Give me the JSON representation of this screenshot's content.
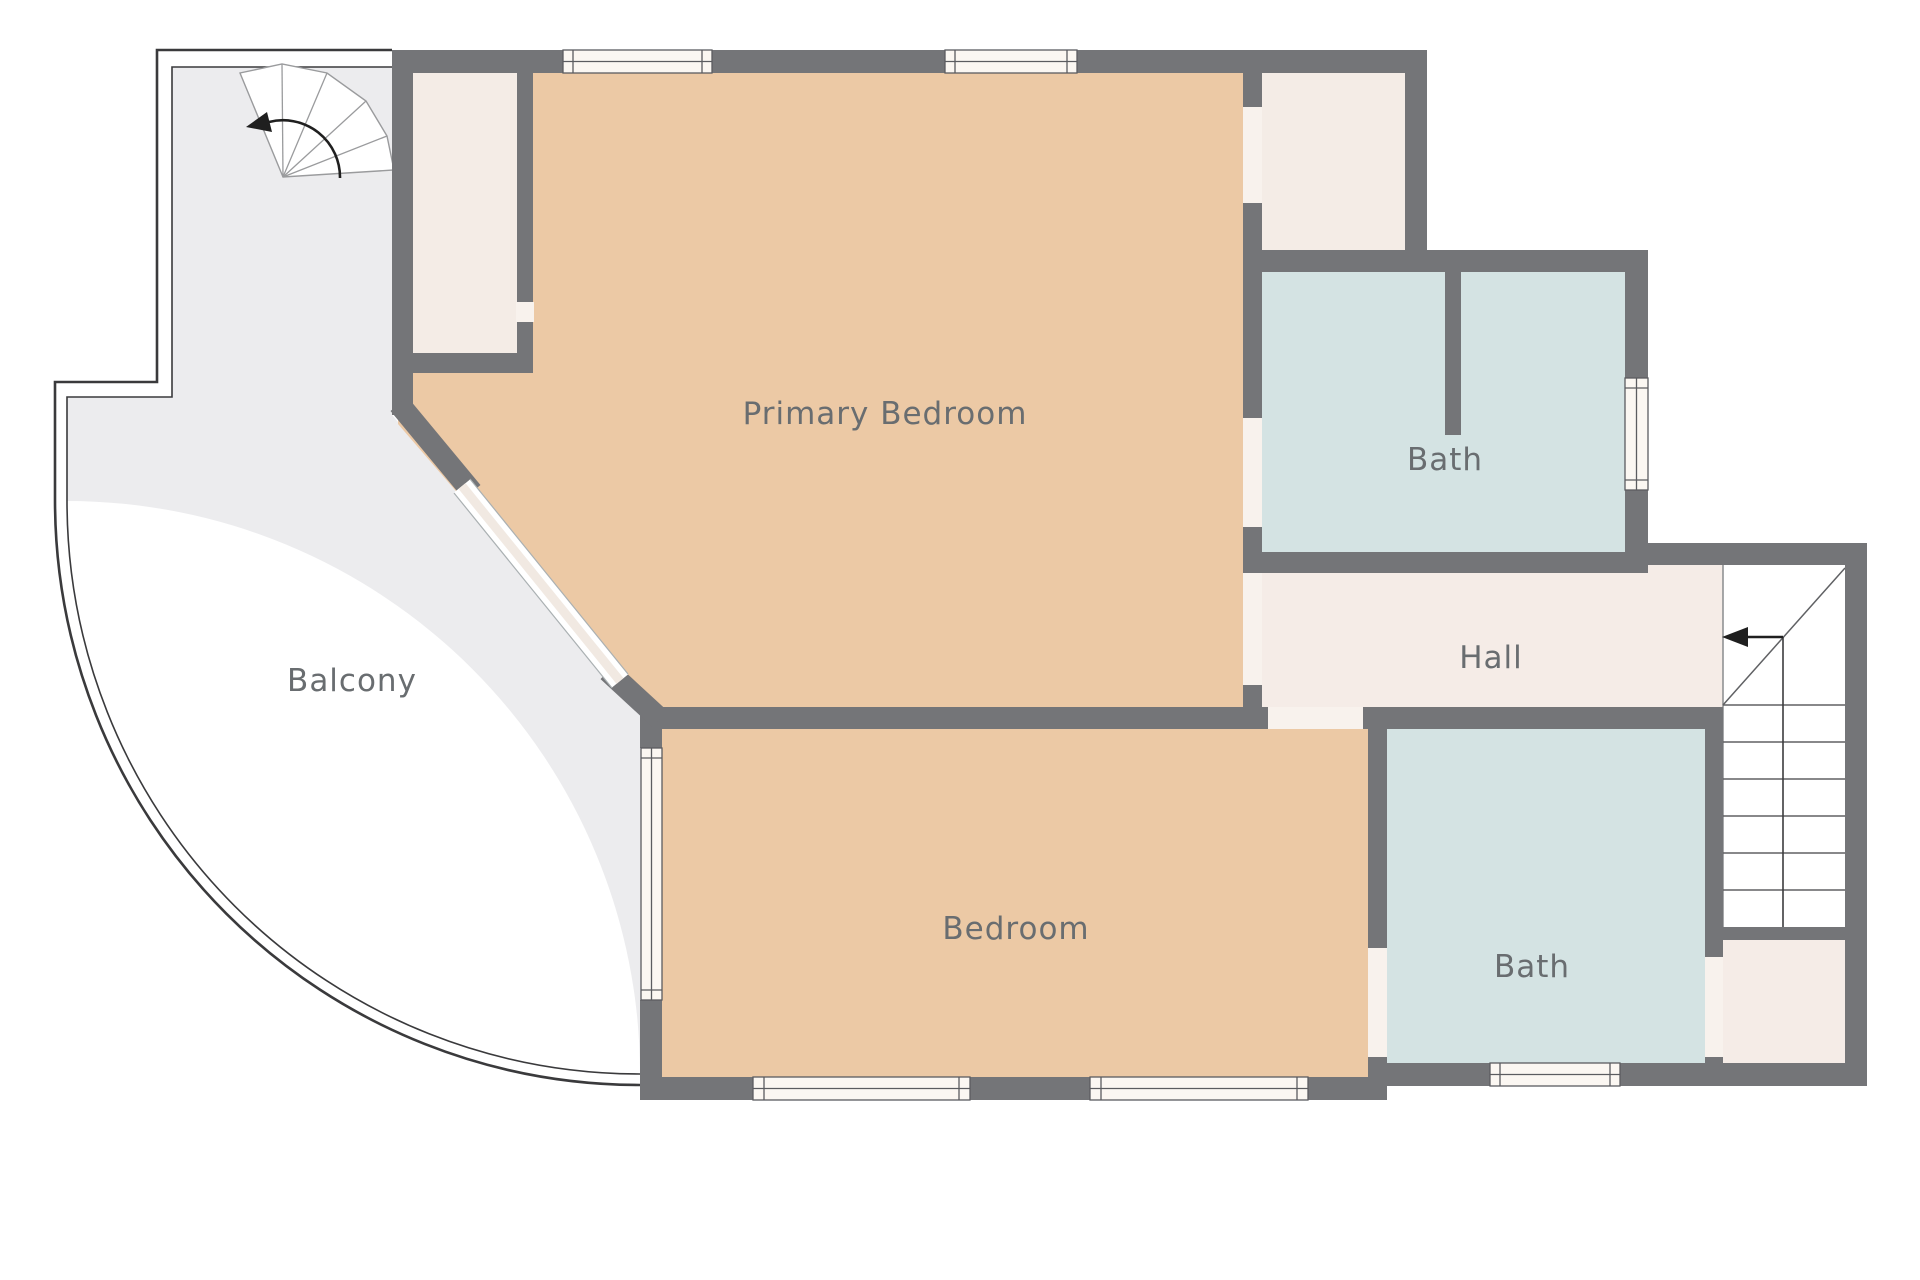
{
  "plan": {
    "type": "floor-plan",
    "floor_shown": "upper floor with balcony and stairs"
  },
  "rooms": [
    {
      "id": "primary-bedroom",
      "label": "Primary Bedroom"
    },
    {
      "id": "bath-ensuite",
      "label": "Bath"
    },
    {
      "id": "hall",
      "label": "Hall"
    },
    {
      "id": "balcony",
      "label": "Balcony"
    },
    {
      "id": "bedroom",
      "label": "Bedroom"
    },
    {
      "id": "bath-main",
      "label": "Bath"
    }
  ],
  "icons": {
    "spiral_stair_arrow": "curved-arrow-left",
    "main_stair_arrow": "arrow-left"
  },
  "colors": {
    "wall": "#747578",
    "room_tan": "#ecc9a5",
    "room_blue": "#d4e3e3",
    "room_cream": "#f5ece7",
    "closet_cream": "#f4ece6",
    "balcony_gray": "#ececee",
    "window_fill": "#fbf7f2",
    "door_gap": "#f8f2ed",
    "label_text": "#696d70",
    "thin_line": "#3a3a3c"
  }
}
